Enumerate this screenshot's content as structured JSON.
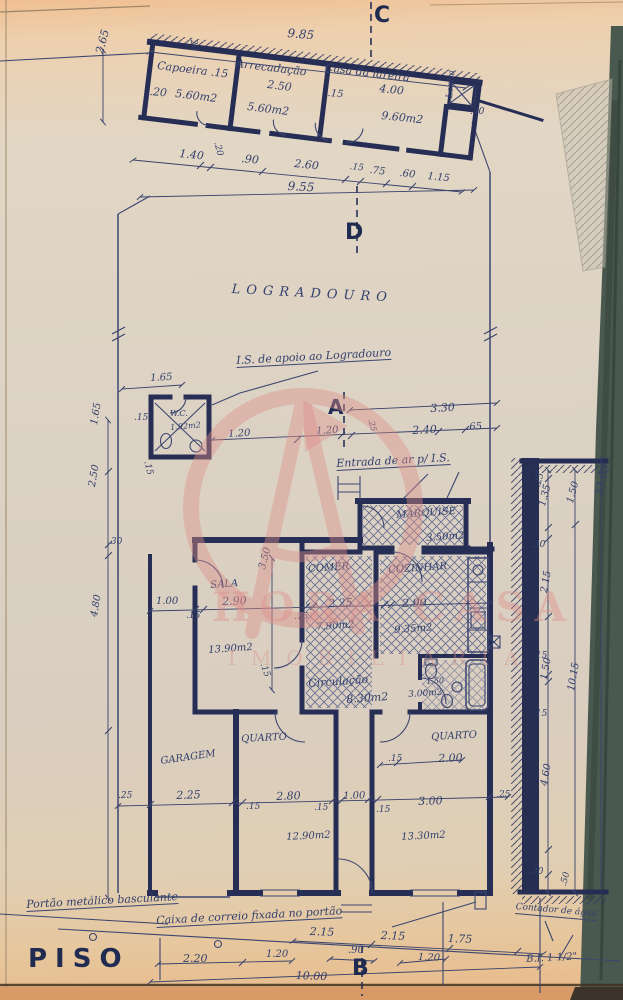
{
  "document": {
    "floor_label": "PISO"
  },
  "watermark": {
    "line1": "HORA CASA",
    "line2": "IMOBILIÁRIA",
    "color": "#dd8f89"
  },
  "ink": {
    "wall_navy": "#272e55",
    "text_navy": "#33406d",
    "paper_edge_green": "#4a594f"
  },
  "labels": [
    {
      "n": "dim-9-85",
      "t": "9.85",
      "x": 288,
      "y": 27,
      "s": 12,
      "r": 5
    },
    {
      "n": "section-marker-c",
      "t": "C",
      "x": 374,
      "y": 5,
      "s": 22,
      "r": 0,
      "c": "b"
    },
    {
      "n": "room-capoeira",
      "t": "Capoeira .15",
      "x": 158,
      "y": 60,
      "s": 11,
      "r": 7
    },
    {
      "n": "dim-capoeira-20v",
      "t": ".20",
      "x": 196,
      "y": 36,
      "s": 9,
      "r": 80
    },
    {
      "n": "dim-capoeira-20",
      "t": ".20",
      "x": 150,
      "y": 86,
      "s": 11,
      "r": 5
    },
    {
      "n": "area-capoeira",
      "t": "5.60m2",
      "x": 176,
      "y": 88,
      "s": 11,
      "r": 7
    },
    {
      "n": "room-arrecadacao",
      "t": "Arrecadação",
      "x": 237,
      "y": 58,
      "s": 11,
      "r": 7
    },
    {
      "n": "dim-arrecadacao-250",
      "t": "2.50",
      "x": 268,
      "y": 79,
      "s": 11,
      "r": 7
    },
    {
      "n": "area-arrecadacao",
      "t": "5.60m2",
      "x": 248,
      "y": 101,
      "s": 11,
      "r": 7
    },
    {
      "n": "dim-15-top",
      "t": ".15",
      "x": 328,
      "y": 89,
      "s": 10,
      "r": 5
    },
    {
      "n": "room-casa-da-lareira",
      "t": "Casa da lareira",
      "x": 326,
      "y": 62,
      "s": 11,
      "r": 7
    },
    {
      "n": "dim-lareira-400",
      "t": "4.00",
      "x": 380,
      "y": 83,
      "s": 11,
      "r": 6
    },
    {
      "n": "area-lareira",
      "t": "9.60m2",
      "x": 382,
      "y": 110,
      "s": 11,
      "r": 6
    },
    {
      "n": "room-lenha",
      "t": "Lenha",
      "x": 446,
      "y": 98,
      "s": 9,
      "r": -85
    },
    {
      "n": "dim-30-top",
      "t": ".30",
      "x": 470,
      "y": 108,
      "s": 9,
      "r": 0
    },
    {
      "n": "dim-2-65",
      "t": "2.65",
      "x": 94,
      "y": 52,
      "s": 11,
      "r": -75
    },
    {
      "n": "dim-1-40",
      "t": "1.40",
      "x": 180,
      "y": 148,
      "s": 11,
      "r": 6
    },
    {
      "n": "dim-20-rot",
      "t": ".20",
      "x": 220,
      "y": 141,
      "s": 9,
      "r": 75
    },
    {
      "n": "dim-90",
      "t": ".90",
      "x": 242,
      "y": 153,
      "s": 11,
      "r": 6
    },
    {
      "n": "dim-2-60",
      "t": "2.60",
      "x": 295,
      "y": 158,
      "s": 11,
      "r": 6
    },
    {
      "n": "dim-15-row",
      "t": ".15",
      "x": 350,
      "y": 163,
      "s": 9,
      "r": 6
    },
    {
      "n": "dim-75",
      "t": ".75",
      "x": 370,
      "y": 166,
      "s": 10,
      "r": 6
    },
    {
      "n": "dim-60",
      "t": ".60",
      "x": 400,
      "y": 169,
      "s": 10,
      "r": 6
    },
    {
      "n": "dim-1-15",
      "t": "1.15",
      "x": 428,
      "y": 172,
      "s": 10,
      "r": 6
    },
    {
      "n": "dim-9-55",
      "t": "9.55",
      "x": 288,
      "y": 180,
      "s": 12,
      "r": 3
    },
    {
      "n": "section-marker-d",
      "t": "D",
      "x": 345,
      "y": 222,
      "s": 22,
      "r": 0,
      "c": "b"
    },
    {
      "n": "site-logradouro",
      "t": "LOGRADOURO",
      "x": 232,
      "y": 283,
      "s": 13,
      "r": 3,
      "c": "ls"
    },
    {
      "n": "note-is-apoio",
      "t": "I.S. de apoio ao Logradouro",
      "x": 236,
      "y": 355,
      "s": 11,
      "r": -3,
      "c": "u"
    },
    {
      "n": "dim-1-65-wc",
      "t": "1.65",
      "x": 150,
      "y": 374,
      "s": 10,
      "r": -3
    },
    {
      "n": "dim-15-wc",
      "t": ".15",
      "x": 134,
      "y": 414,
      "s": 9,
      "r": 0
    },
    {
      "n": "room-wc",
      "t": "W.C.",
      "x": 170,
      "y": 410,
      "s": 8,
      "r": 0
    },
    {
      "n": "area-wc",
      "t": "1.92m2",
      "x": 170,
      "y": 424,
      "s": 8,
      "r": -5
    },
    {
      "n": "dim-15-wc2",
      "t": ".15",
      "x": 150,
      "y": 460,
      "s": 9,
      "r": 75
    },
    {
      "n": "dim-1-65-col",
      "t": "1.65",
      "x": 90,
      "y": 424,
      "s": 10,
      "r": -80
    },
    {
      "n": "dim-2-50-col",
      "t": "2.50",
      "x": 88,
      "y": 486,
      "s": 10,
      "r": -80
    },
    {
      "n": "dim-30-col",
      "t": ".30",
      "x": 108,
      "y": 538,
      "s": 9,
      "r": 0
    },
    {
      "n": "dim-4-80-col",
      "t": "4.80",
      "x": 90,
      "y": 616,
      "s": 10,
      "r": -80
    },
    {
      "n": "dim-1-00-drive",
      "t": "1.00",
      "x": 156,
      "y": 597,
      "s": 10,
      "r": 0
    },
    {
      "n": "section-marker-a",
      "t": "A",
      "x": 328,
      "y": 397,
      "s": 20,
      "r": 0,
      "c": "b"
    },
    {
      "n": "dim-3-30",
      "t": "3.30",
      "x": 430,
      "y": 403,
      "s": 11,
      "r": -3
    },
    {
      "n": "dim-25-a",
      "t": ".25",
      "x": 374,
      "y": 418,
      "s": 8,
      "r": 75
    },
    {
      "n": "dim-1-20-wc",
      "t": "1.20",
      "x": 228,
      "y": 430,
      "s": 10,
      "r": -3
    },
    {
      "n": "dim-1-20-a",
      "t": "1.20",
      "x": 316,
      "y": 427,
      "s": 10,
      "r": -3
    },
    {
      "n": "dim-2-40",
      "t": "2.40",
      "x": 412,
      "y": 425,
      "s": 11,
      "r": -3
    },
    {
      "n": "dim-65",
      "t": ".65",
      "x": 466,
      "y": 423,
      "s": 10,
      "r": -3
    },
    {
      "n": "note-entrada-ar",
      "t": "Entrada de ar p/ I.S.",
      "x": 336,
      "y": 458,
      "s": 11,
      "r": -3,
      "c": "u"
    },
    {
      "n": "room-marquise",
      "t": "MARQUISE",
      "x": 396,
      "y": 511,
      "s": 10,
      "r": -4
    },
    {
      "n": "area-marquise",
      "t": "3.50m2",
      "x": 426,
      "y": 534,
      "s": 10,
      "r": -4
    },
    {
      "n": "room-sala",
      "t": "SALA",
      "x": 210,
      "y": 581,
      "s": 10,
      "r": -4
    },
    {
      "n": "dim-3-50-v",
      "t": "3.50",
      "x": 258,
      "y": 568,
      "s": 10,
      "r": -75
    },
    {
      "n": "dim-2-90-sala",
      "t": "2.90",
      "x": 222,
      "y": 596,
      "s": 11,
      "r": -2
    },
    {
      "n": "dim-15-s1",
      "t": ".15",
      "x": 186,
      "y": 612,
      "s": 9,
      "r": 0
    },
    {
      "n": "dim-15-s2",
      "t": ".15",
      "x": 294,
      "y": 613,
      "s": 9,
      "r": 0
    },
    {
      "n": "dim-2-25",
      "t": "2.25",
      "x": 328,
      "y": 598,
      "s": 11,
      "r": -2
    },
    {
      "n": "dim-2-90-coz",
      "t": "2.90",
      "x": 402,
      "y": 598,
      "s": 11,
      "r": -2
    },
    {
      "n": "area-comer",
      "t": "7.90m2",
      "x": 316,
      "y": 623,
      "s": 10,
      "r": -4
    },
    {
      "n": "area-cozinha",
      "t": "9.35m2",
      "x": 394,
      "y": 626,
      "s": 10,
      "r": -4
    },
    {
      "n": "area-sala",
      "t": "13.90m2",
      "x": 208,
      "y": 646,
      "s": 10,
      "r": -4
    },
    {
      "n": "room-comer",
      "t": "COMER",
      "x": 308,
      "y": 565,
      "s": 10,
      "r": -4
    },
    {
      "n": "room-cozinha",
      "t": "COZINHAR",
      "x": 388,
      "y": 566,
      "s": 10,
      "r": -4
    },
    {
      "n": "dim-15-circ",
      "t": ".15",
      "x": 266,
      "y": 662,
      "s": 9,
      "r": 70
    },
    {
      "n": "room-circulacao",
      "t": "Circulação",
      "x": 308,
      "y": 678,
      "s": 11,
      "r": -4
    },
    {
      "n": "area-circulacao",
      "t": "8.30m2",
      "x": 346,
      "y": 694,
      "s": 11,
      "r": -4
    },
    {
      "n": "dim-1-50-bath",
      "t": "1.50",
      "x": 426,
      "y": 678,
      "s": 8,
      "r": -4
    },
    {
      "n": "area-bath",
      "t": "3.00m2",
      "x": 408,
      "y": 691,
      "s": 9,
      "r": -4
    },
    {
      "n": "room-quarto-1",
      "t": "QUARTO",
      "x": 241,
      "y": 735,
      "s": 10,
      "r": -3
    },
    {
      "n": "room-garagem",
      "t": "GARAGEM",
      "x": 160,
      "y": 757,
      "s": 10,
      "r": -8
    },
    {
      "n": "dim-25-bl",
      "t": ".25",
      "x": 118,
      "y": 792,
      "s": 9,
      "r": 0
    },
    {
      "n": "dim-2-25-g",
      "t": "2.25",
      "x": 176,
      "y": 790,
      "s": 11,
      "r": -2
    },
    {
      "n": "dim-15-b1",
      "t": ".15",
      "x": 246,
      "y": 803,
      "s": 9,
      "r": 0
    },
    {
      "n": "dim-2-80",
      "t": "2.80",
      "x": 276,
      "y": 791,
      "s": 11,
      "r": -2
    },
    {
      "n": "dim-15-b2",
      "t": ".15",
      "x": 314,
      "y": 804,
      "s": 9,
      "r": 0
    },
    {
      "n": "dim-1-00-c",
      "t": "1.00",
      "x": 343,
      "y": 792,
      "s": 10,
      "r": -2
    },
    {
      "n": "area-quarto-1",
      "t": "12.90m2",
      "x": 286,
      "y": 833,
      "s": 10,
      "r": -3
    },
    {
      "n": "room-quarto-2",
      "t": "QUARTO",
      "x": 431,
      "y": 733,
      "s": 10,
      "r": -3
    },
    {
      "n": "dim-15-q2",
      "t": ".15",
      "x": 388,
      "y": 755,
      "s": 9,
      "r": 0
    },
    {
      "n": "dim-2-00",
      "t": "2.00",
      "x": 438,
      "y": 753,
      "s": 11,
      "r": -2
    },
    {
      "n": "dim-3-00",
      "t": "3.00",
      "x": 418,
      "y": 796,
      "s": 11,
      "r": -2
    },
    {
      "n": "dim-25-br",
      "t": ".25",
      "x": 496,
      "y": 791,
      "s": 9,
      "r": -2
    },
    {
      "n": "dim-15-b3",
      "t": ".15",
      "x": 376,
      "y": 806,
      "s": 9,
      "r": 0
    },
    {
      "n": "area-quarto-2",
      "t": "13.30m2",
      "x": 401,
      "y": 833,
      "s": 10,
      "r": -3
    },
    {
      "n": "dim-rc-25",
      "t": ".25",
      "x": 534,
      "y": 486,
      "s": 9,
      "r": -75
    },
    {
      "n": "dim-rc-1-35",
      "t": "1.35",
      "x": 538,
      "y": 505,
      "s": 10,
      "r": -75
    },
    {
      "n": "dim-rc-1-50a",
      "t": "1.50",
      "x": 566,
      "y": 502,
      "s": 10,
      "r": -75
    },
    {
      "n": "dim-rc-33-00",
      "t": "33.00",
      "x": 593,
      "y": 494,
      "s": 11,
      "r": -75
    },
    {
      "n": "dim-rc-30",
      "t": ".30",
      "x": 531,
      "y": 541,
      "s": 9,
      "r": 0
    },
    {
      "n": "dim-rc-2-15",
      "t": "2.15",
      "x": 540,
      "y": 592,
      "s": 10,
      "r": -80
    },
    {
      "n": "dim-rc-15a",
      "t": ".15",
      "x": 533,
      "y": 652,
      "s": 9,
      "r": 0
    },
    {
      "n": "dim-rc-1-50b",
      "t": "1.50",
      "x": 540,
      "y": 679,
      "s": 10,
      "r": -80
    },
    {
      "n": "dim-rc-10-15",
      "t": "10.15",
      "x": 567,
      "y": 690,
      "s": 10,
      "r": -80
    },
    {
      "n": "dim-rc-15b",
      "t": ".15",
      "x": 533,
      "y": 710,
      "s": 9,
      "r": 0
    },
    {
      "n": "dim-rc-4-60",
      "t": "4.60",
      "x": 540,
      "y": 785,
      "s": 10,
      "r": -80
    },
    {
      "n": "dim-rc-30b",
      "t": ".30",
      "x": 529,
      "y": 868,
      "s": 9,
      "r": 0
    },
    {
      "n": "dim-rc-50",
      "t": ".50",
      "x": 560,
      "y": 885,
      "s": 9,
      "r": -75
    },
    {
      "n": "note-portao",
      "t": "Portão metálico basculante",
      "x": 26,
      "y": 899,
      "s": 11,
      "r": -3,
      "c": "u"
    },
    {
      "n": "note-caixa-correio",
      "t": "Caixa de correio fixada no portão",
      "x": 156,
      "y": 915,
      "s": 11,
      "r": -3,
      "c": "u"
    },
    {
      "n": "note-contador-agua",
      "t": "Contador de água",
      "x": 516,
      "y": 903,
      "s": 9,
      "r": 5,
      "c": "u"
    },
    {
      "n": "dim-bd-2-15a",
      "t": "2.15",
      "x": 310,
      "y": 926,
      "s": 11,
      "r": 2
    },
    {
      "n": "dim-bd-2-15b",
      "t": "2.15",
      "x": 381,
      "y": 930,
      "s": 11,
      "r": 2
    },
    {
      "n": "dim-bd-1-75",
      "t": "1.75",
      "x": 448,
      "y": 933,
      "s": 11,
      "r": 2
    },
    {
      "n": "dim-bd-90",
      "t": ".90",
      "x": 348,
      "y": 946,
      "s": 10,
      "r": 0
    },
    {
      "n": "dim-bd-1-20b",
      "t": "1.20",
      "x": 418,
      "y": 953,
      "s": 10,
      "r": 2
    },
    {
      "n": "note-bi",
      "t": "B.I. 1 1/2\"",
      "x": 526,
      "y": 955,
      "s": 10,
      "r": -3
    },
    {
      "n": "title-piso",
      "t": "PISO",
      "x": 28,
      "y": 946,
      "s": 26,
      "r": 0,
      "c": "b ls2"
    },
    {
      "n": "dim-bd-2-20",
      "t": "2.20",
      "x": 183,
      "y": 953,
      "s": 11,
      "r": 0
    },
    {
      "n": "dim-bd-1-20a",
      "t": "1.20",
      "x": 266,
      "y": 950,
      "s": 10,
      "r": 0
    },
    {
      "n": "section-marker-b",
      "t": "B",
      "x": 352,
      "y": 958,
      "s": 22,
      "r": 0,
      "c": "b"
    },
    {
      "n": "dim-bd-10-00",
      "t": "10.00",
      "x": 296,
      "y": 970,
      "s": 11,
      "r": 2
    }
  ]
}
